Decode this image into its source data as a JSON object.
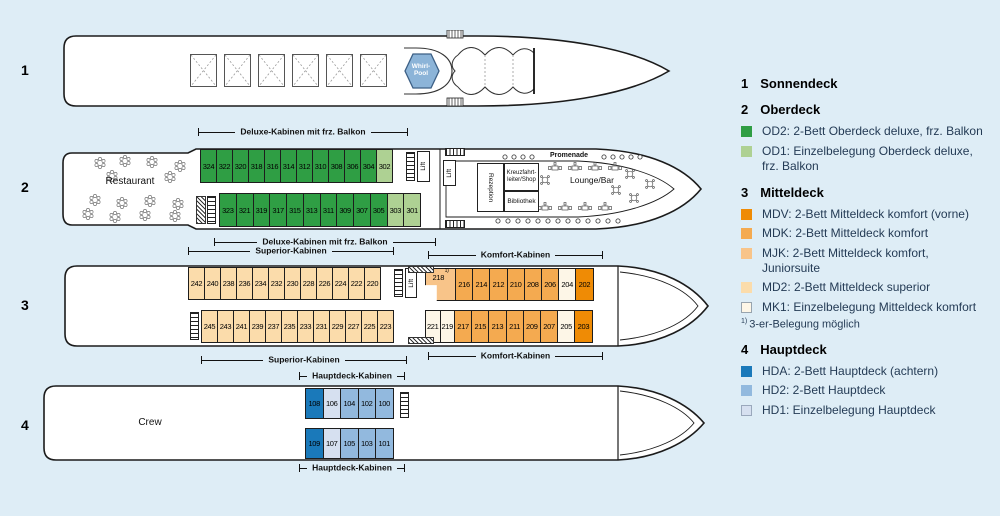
{
  "colors": {
    "od2": "#2f9e44",
    "od1": "#aed193",
    "mdv": "#ef8b05",
    "mdk": "#f4aa50",
    "mjk": "#f8c489",
    "md2": "#fbdcab",
    "mk1": "#fdf6e7",
    "hda": "#1a79ba",
    "hd2": "#92b9de",
    "hd1": "#d6e0f0"
  },
  "deck_numbers": {
    "d1": "1",
    "d2": "2",
    "d3": "3",
    "d4": "4"
  },
  "labels": {
    "deluxe": "Deluxe-Kabinen mit frz. Balkon",
    "superior": "Superior-Kabinen",
    "komfort": "Komfort-Kabinen",
    "hauptdeck": "Hauptdeck-Kabinen"
  },
  "facilities": {
    "restaurant": "Restaurant",
    "whirlpool": "Whirl-Pool",
    "lift": "Lift",
    "rezeption": "Rezeption",
    "kreuzfahrtleiter": "Kreuzfahrt-leiter/Shop",
    "bibliothek": "Bibliothek",
    "lounge": "Lounge/Bar",
    "promenade": "Promenade",
    "crew": "Crew"
  },
  "cabins": {
    "oberdeck_top": [
      {
        "n": "324",
        "t": "od2"
      },
      {
        "n": "322",
        "t": "od2"
      },
      {
        "n": "320",
        "t": "od2"
      },
      {
        "n": "318",
        "t": "od2"
      },
      {
        "n": "316",
        "t": "od2"
      },
      {
        "n": "314",
        "t": "od2"
      },
      {
        "n": "312",
        "t": "od2"
      },
      {
        "n": "310",
        "t": "od2"
      },
      {
        "n": "308",
        "t": "od2"
      },
      {
        "n": "306",
        "t": "od2"
      },
      {
        "n": "304",
        "t": "od2"
      },
      {
        "n": "302",
        "t": "od1"
      }
    ],
    "oberdeck_bottom": [
      {
        "n": "323",
        "t": "od2"
      },
      {
        "n": "321",
        "t": "od2"
      },
      {
        "n": "319",
        "t": "od2"
      },
      {
        "n": "317",
        "t": "od2"
      },
      {
        "n": "315",
        "t": "od2"
      },
      {
        "n": "313",
        "t": "od2"
      },
      {
        "n": "311",
        "t": "od2"
      },
      {
        "n": "309",
        "t": "od2"
      },
      {
        "n": "307",
        "t": "od2"
      },
      {
        "n": "305",
        "t": "od2"
      },
      {
        "n": "303",
        "t": "od1"
      },
      {
        "n": "301",
        "t": "od1"
      }
    ],
    "mitteldeck_superior_top": [
      {
        "n": "242",
        "t": "md2"
      },
      {
        "n": "240",
        "t": "md2"
      },
      {
        "n": "238",
        "t": "md2"
      },
      {
        "n": "236",
        "t": "md2"
      },
      {
        "n": "234",
        "t": "md2"
      },
      {
        "n": "232",
        "t": "md2"
      },
      {
        "n": "230",
        "t": "md2"
      },
      {
        "n": "228",
        "t": "md2"
      },
      {
        "n": "226",
        "t": "md2"
      },
      {
        "n": "224",
        "t": "md2"
      },
      {
        "n": "222",
        "t": "md2"
      },
      {
        "n": "220",
        "t": "md2"
      }
    ],
    "mitteldeck_superior_bottom": [
      {
        "n": "245",
        "t": "md2"
      },
      {
        "n": "243",
        "t": "md2"
      },
      {
        "n": "241",
        "t": "md2"
      },
      {
        "n": "239",
        "t": "md2"
      },
      {
        "n": "237",
        "t": "md2"
      },
      {
        "n": "235",
        "t": "md2"
      },
      {
        "n": "233",
        "t": "md2"
      },
      {
        "n": "231",
        "t": "md2"
      },
      {
        "n": "229",
        "t": "md2"
      },
      {
        "n": "227",
        "t": "md2"
      },
      {
        "n": "225",
        "t": "md2"
      },
      {
        "n": "223",
        "t": "md2"
      }
    ],
    "mitteldeck_komfort_top": [
      {
        "n": "218",
        "t": "mjk",
        "w": 31,
        "shape": "L",
        "sup": "1)"
      },
      {
        "n": "216",
        "t": "mdk"
      },
      {
        "n": "214",
        "t": "mdk"
      },
      {
        "n": "212",
        "t": "mdk"
      },
      {
        "n": "210",
        "t": "mdk"
      },
      {
        "n": "208",
        "t": "mdk"
      },
      {
        "n": "206",
        "t": "mdk"
      },
      {
        "n": "204",
        "t": "mk1"
      },
      {
        "n": "202",
        "t": "mdv"
      }
    ],
    "mitteldeck_komfort_bottom": [
      {
        "n": "221",
        "t": "mk1",
        "w": 15.5
      },
      {
        "n": "219",
        "t": "mk1",
        "w": 15.5
      },
      {
        "n": "217",
        "t": "mdk"
      },
      {
        "n": "215",
        "t": "mdk"
      },
      {
        "n": "213",
        "t": "mdk"
      },
      {
        "n": "211",
        "t": "mdk"
      },
      {
        "n": "209",
        "t": "mdk"
      },
      {
        "n": "207",
        "t": "mdk"
      },
      {
        "n": "205",
        "t": "mk1"
      },
      {
        "n": "203",
        "t": "mdv"
      }
    ],
    "hauptdeck_top": [
      {
        "n": "108",
        "t": "hda"
      },
      {
        "n": "106",
        "t": "hd1"
      },
      {
        "n": "104",
        "t": "hd2"
      },
      {
        "n": "102",
        "t": "hd2"
      },
      {
        "n": "100",
        "t": "hd2"
      }
    ],
    "hauptdeck_bottom": [
      {
        "n": "109",
        "t": "hda"
      },
      {
        "n": "107",
        "t": "hd1"
      },
      {
        "n": "105",
        "t": "hd2"
      },
      {
        "n": "103",
        "t": "hd2"
      },
      {
        "n": "101",
        "t": "hd2"
      }
    ]
  },
  "legend": {
    "sections": [
      {
        "num": "1",
        "title": "Sonnendeck"
      },
      {
        "num": "2",
        "title": "Oberdeck",
        "items": [
          {
            "color": "od2",
            "text": "OD2: 2-Bett Oberdeck deluxe, frz. Balkon"
          },
          {
            "color": "od1",
            "text": "OD1: Einzelbelegung Oberdeck deluxe, frz. Balkon"
          }
        ]
      },
      {
        "num": "3",
        "title": "Mitteldeck",
        "items": [
          {
            "color": "mdv",
            "text": "MDV: 2-Bett Mitteldeck komfort (vorne)"
          },
          {
            "color": "mdk",
            "text": "MDK: 2-Bett Mitteldeck komfort"
          },
          {
            "color": "mjk",
            "text": "MJK: 2-Bett Mitteldeck komfort, Juniorsuite"
          },
          {
            "color": "md2",
            "text": "MD2: 2-Bett Mitteldeck superior"
          },
          {
            "color": "mk1",
            "text": "MK1: Einzelbelegung Mitteldeck komfort"
          }
        ],
        "footnote_marker": "1)",
        "footnote": "3-er-Belegung möglich"
      },
      {
        "num": "4",
        "title": "Hauptdeck",
        "items": [
          {
            "color": "hda",
            "text": "HDA: 2-Bett Hauptdeck (achtern)"
          },
          {
            "color": "hd2",
            "text": "HD2: 2-Bett Hauptdeck"
          },
          {
            "color": "hd1",
            "text": "HD1: Einzelbelegung Hauptdeck"
          }
        ]
      }
    ]
  }
}
